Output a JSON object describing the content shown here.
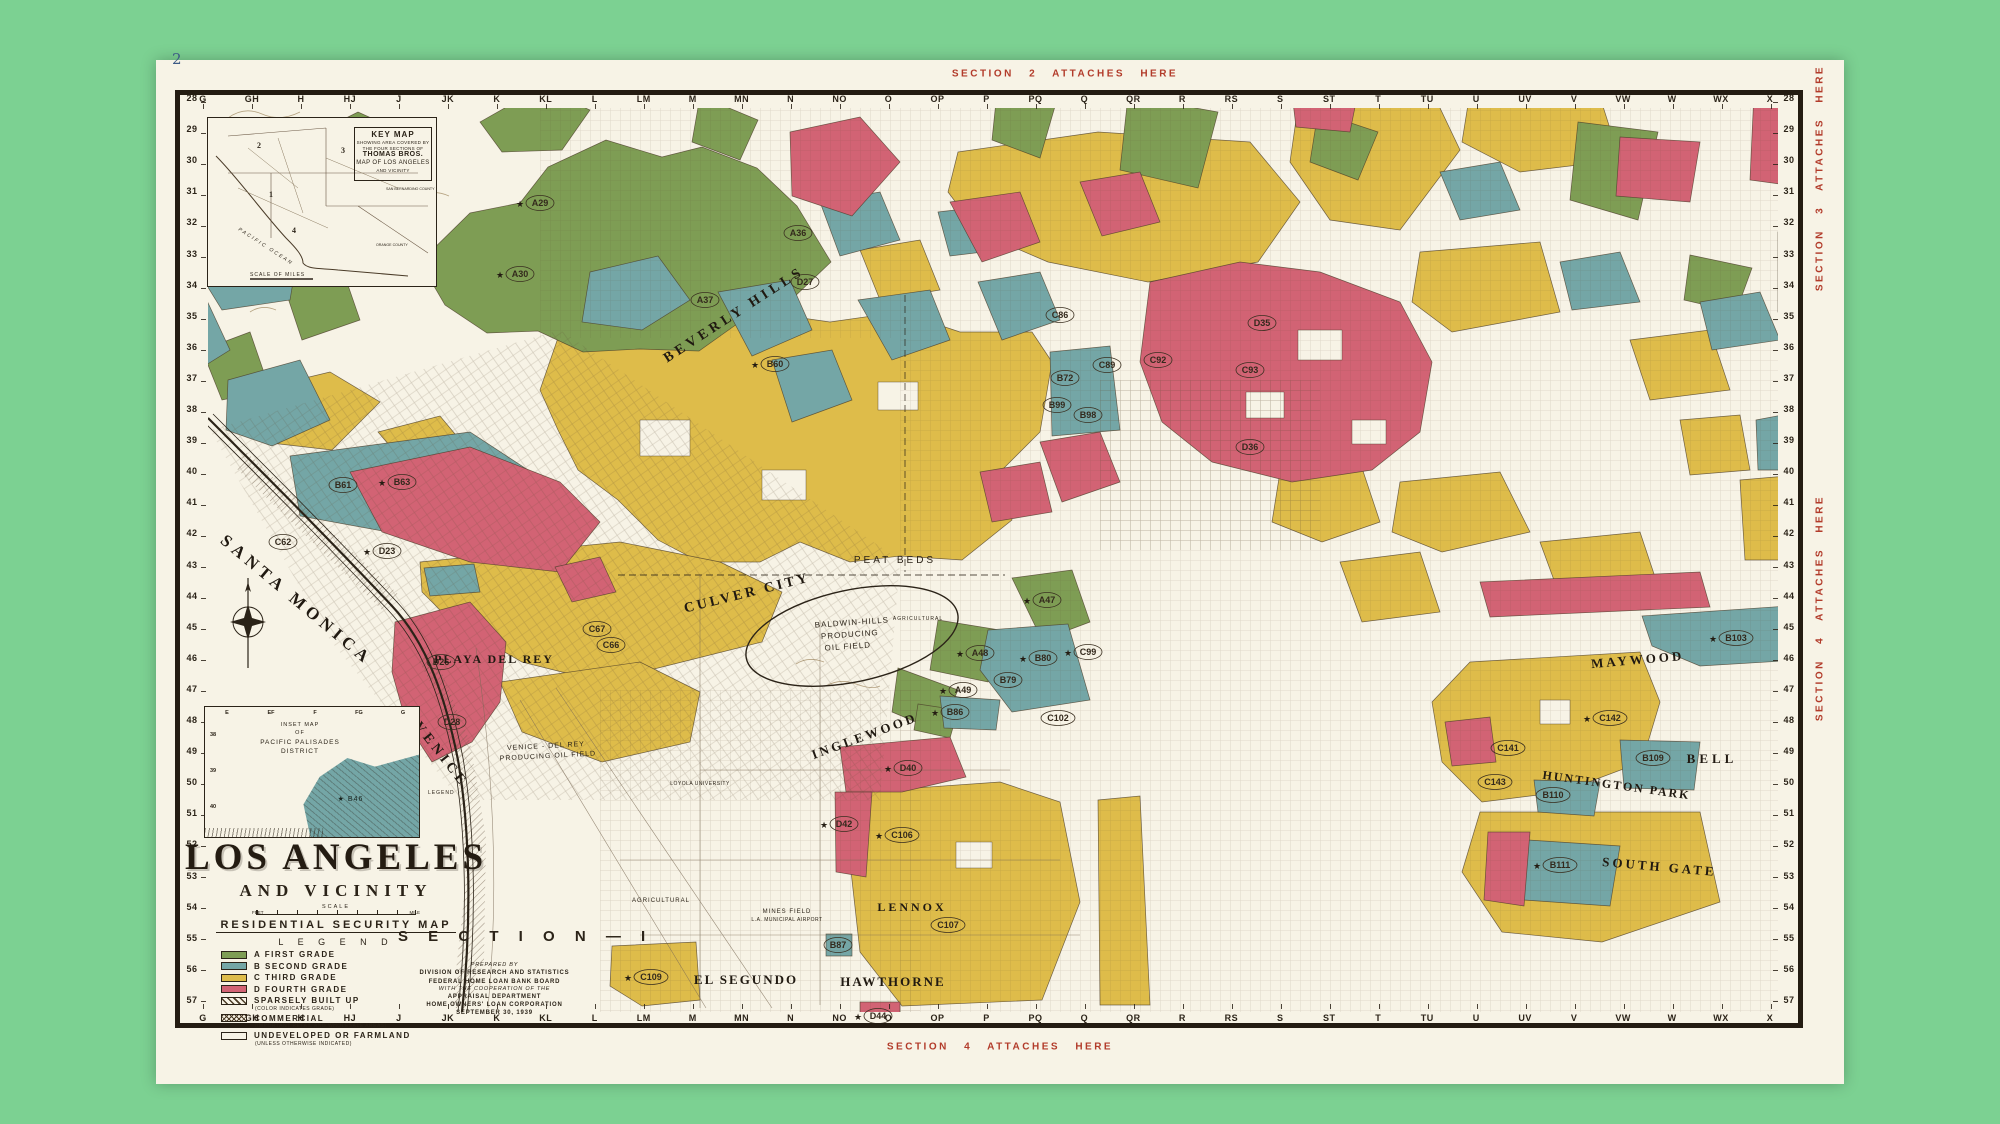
{
  "page": {
    "page_number": "2"
  },
  "colors": {
    "background": "#7cd192",
    "paper": "#f7f3e6",
    "ink": "#2b2318",
    "overprint_red": "#b23b2a",
    "grade_a_green": "#7e9d54",
    "grade_b_blue": "#74a6a6",
    "grade_c_yellow": "#debc4a",
    "grade_d_red": "#d26374"
  },
  "section_stamps": {
    "top": "SECTION 2 ATTACHES HERE",
    "bottom": "SECTION 4 ATTACHES HERE",
    "right_upper": "SECTION 3 ATTACHES HERE",
    "right_lower": "SECTION 4 ATTACHES HERE"
  },
  "title_block": {
    "title": "LOS ANGELES",
    "subtitle": "AND VICINITY",
    "scale_label": "SCALE",
    "scale_feet": "FEET",
    "scale_mile": "MILE",
    "map_type": "RESIDENTIAL SECURITY MAP",
    "legend_heading": "L E G E N D",
    "section_label": "S E C T I O N — I"
  },
  "legend": {
    "items": [
      {
        "swatch": "a",
        "letter": "A",
        "label": "FIRST GRADE",
        "note": ""
      },
      {
        "swatch": "b",
        "letter": "B",
        "label": "SECOND GRADE",
        "note": ""
      },
      {
        "swatch": "c",
        "letter": "C",
        "label": "THIRD GRADE",
        "note": ""
      },
      {
        "swatch": "d",
        "letter": "D",
        "label": "FOURTH GRADE",
        "note": ""
      },
      {
        "swatch": "hatch",
        "letter": "",
        "label": "SPARSELY BUILT UP",
        "note": "(COLOR INDICATES GRADE)"
      },
      {
        "swatch": "commercial",
        "letter": "",
        "label": "COMMERCIAL",
        "note": "(IMPORTANT RETAIL AND WHOLESALE AREAS)"
      },
      {
        "swatch": "white",
        "letter": "",
        "label": "UNDEVELOPED OR FARMLAND",
        "note": "(UNLESS OTHERWISE INDICATED)"
      }
    ]
  },
  "credits": {
    "lines": [
      "PREPARED BY",
      "DIVISION OF RESEARCH AND STATISTICS",
      "FEDERAL HOME LOAN BANK BOARD",
      "WITH THE COOPERATION OF THE",
      "APPRAISAL DEPARTMENT",
      "HOME OWNERS' LOAN CORPORATION",
      "SEPTEMBER 30, 1939"
    ]
  },
  "key_map": {
    "title": "KEY MAP",
    "sub1": "SHOWING AREA COVERED BY",
    "sub2": "THE FOUR SECTIONS OF",
    "publisher": "THOMAS BROS.",
    "sub3": "MAP OF LOS ANGELES",
    "sub4": "AND VICINITY",
    "section_1": "1",
    "section_2": "2",
    "section_3": "3",
    "section_4": "4",
    "ocean_label": "PACIFIC OCEAN",
    "scale_label": "SCALE OF MILES",
    "county_1": "SAN BERNARDINO COUNTY",
    "county_2": "ORANGE COUNTY"
  },
  "inset_map": {
    "line1": "INSET MAP",
    "line2": "OF",
    "line3": "PACIFIC PALISADES",
    "line4": "DISTRICT",
    "zone_label": "B46",
    "col_letters": [
      "E",
      "EF",
      "F",
      "FG",
      "G"
    ],
    "row_numbers": [
      "38",
      "39",
      "40"
    ],
    "legend_label": "LEGEND"
  },
  "frame": {
    "col_letters": [
      "G",
      "GH",
      "H",
      "HJ",
      "J",
      "JK",
      "K",
      "KL",
      "L",
      "LM",
      "M",
      "MN",
      "N",
      "NO",
      "O",
      "OP",
      "P",
      "PQ",
      "Q",
      "QR",
      "R",
      "RS",
      "S",
      "ST",
      "T",
      "TU",
      "U",
      "UV",
      "V",
      "VW",
      "W",
      "WX",
      "X"
    ],
    "row_numbers": [
      "28",
      "29",
      "30",
      "31",
      "32",
      "33",
      "34",
      "35",
      "36",
      "37",
      "38",
      "39",
      "40",
      "41",
      "42",
      "43",
      "44",
      "45",
      "46",
      "47",
      "48",
      "49",
      "50",
      "51",
      "52",
      "53",
      "54",
      "55",
      "56",
      "57"
    ]
  },
  "map_labels": [
    {
      "t": "SANTA MONICA",
      "x": 293,
      "y": 604,
      "r": 40,
      "s": 17,
      "ls": 5,
      "f": "serif"
    },
    {
      "t": "VENICE",
      "x": 438,
      "y": 757,
      "r": 52,
      "s": 14,
      "ls": 4,
      "f": "serif"
    },
    {
      "t": "BEVERLY HILLS",
      "x": 736,
      "y": 318,
      "r": -33,
      "s": 14,
      "ls": 4,
      "f": "serif"
    },
    {
      "t": "CULVER CITY",
      "x": 748,
      "y": 597,
      "r": -14,
      "s": 14,
      "ls": 3,
      "f": "serif"
    },
    {
      "t": "INGLEWOOD",
      "x": 866,
      "y": 740,
      "r": -20,
      "s": 13,
      "ls": 3,
      "f": "serif"
    },
    {
      "t": "PLAYA DEL REY",
      "x": 494,
      "y": 663,
      "r": 0,
      "s": 12,
      "ls": 2,
      "f": "serif"
    },
    {
      "t": "EL SEGUNDO",
      "x": 746,
      "y": 984,
      "r": 0,
      "s": 13,
      "ls": 2,
      "f": "serif"
    },
    {
      "t": "HAWTHORNE",
      "x": 893,
      "y": 986,
      "r": 0,
      "s": 13,
      "ls": 2,
      "f": "serif"
    },
    {
      "t": "LENNOX",
      "x": 912,
      "y": 911,
      "r": 0,
      "s": 12,
      "ls": 3,
      "f": "serif"
    },
    {
      "t": "MAYWOOD",
      "x": 1638,
      "y": 664,
      "r": -5,
      "s": 13,
      "ls": 3,
      "f": "serif"
    },
    {
      "t": "BELL",
      "x": 1712,
      "y": 763,
      "r": 0,
      "s": 13,
      "ls": 4,
      "f": "serif"
    },
    {
      "t": "HUNTINGTON PARK",
      "x": 1616,
      "y": 789,
      "r": 8,
      "s": 12,
      "ls": 2,
      "f": "serif"
    },
    {
      "t": "SOUTH GATE",
      "x": 1659,
      "y": 871,
      "r": 5,
      "s": 13,
      "ls": 3,
      "f": "serif"
    },
    {
      "t": "PEAT BEDS",
      "x": 895,
      "y": 563,
      "r": 0,
      "s": 10,
      "ls": 3,
      "f": "sans"
    },
    {
      "t": "BALDWIN-HILLS",
      "x": 852,
      "y": 625,
      "r": -4,
      "s": 8,
      "ls": 1,
      "f": "sans"
    },
    {
      "t": "PRODUCING",
      "x": 850,
      "y": 637,
      "r": -4,
      "s": 8,
      "ls": 1,
      "f": "sans"
    },
    {
      "t": "OIL FIELD",
      "x": 848,
      "y": 649,
      "r": -4,
      "s": 8,
      "ls": 1,
      "f": "sans"
    },
    {
      "t": "VENICE - DEL REY",
      "x": 546,
      "y": 748,
      "r": -3,
      "s": 7,
      "ls": 1,
      "f": "sans"
    },
    {
      "t": "PRODUCING OIL FIELD",
      "x": 548,
      "y": 758,
      "r": -3,
      "s": 7,
      "ls": 1,
      "f": "sans"
    },
    {
      "t": "MINES FIELD",
      "x": 787,
      "y": 913,
      "r": 0,
      "s": 6,
      "ls": 1,
      "f": "sans"
    },
    {
      "t": "L.A. MUNICIPAL AIRPORT",
      "x": 787,
      "y": 921,
      "r": 0,
      "s": 5,
      "ls": 0.5,
      "f": "sans"
    },
    {
      "t": "LOYOLA UNIVERSITY",
      "x": 700,
      "y": 785,
      "r": 0,
      "s": 5,
      "ls": 0.5,
      "f": "sans"
    },
    {
      "t": "AGRICULTURAL",
      "x": 661,
      "y": 902,
      "r": 0,
      "s": 6,
      "ls": 1,
      "f": "sans"
    },
    {
      "t": "AGRICULTURAL",
      "x": 918,
      "y": 620,
      "r": 0,
      "s": 5,
      "ls": 1,
      "f": "sans"
    }
  ],
  "zone_labels": [
    {
      "c": "A29",
      "x": 540,
      "y": 203,
      "star": true
    },
    {
      "c": "A30",
      "x": 520,
      "y": 274,
      "star": true
    },
    {
      "c": "A36",
      "x": 798,
      "y": 233,
      "star": false
    },
    {
      "c": "A37",
      "x": 705,
      "y": 300,
      "star": false
    },
    {
      "c": "D27",
      "x": 805,
      "y": 282,
      "star": false
    },
    {
      "c": "B60",
      "x": 775,
      "y": 364,
      "star": true
    },
    {
      "c": "B61",
      "x": 343,
      "y": 485,
      "star": false
    },
    {
      "c": "B63",
      "x": 402,
      "y": 482,
      "star": true
    },
    {
      "c": "D23",
      "x": 387,
      "y": 551,
      "star": true
    },
    {
      "c": "C62",
      "x": 283,
      "y": 542,
      "star": false
    },
    {
      "c": "D26",
      "x": 441,
      "y": 662,
      "star": false
    },
    {
      "c": "D28",
      "x": 452,
      "y": 722,
      "star": false
    },
    {
      "c": "C67",
      "x": 597,
      "y": 629,
      "star": false
    },
    {
      "c": "C66",
      "x": 611,
      "y": 645,
      "star": false
    },
    {
      "c": "C86",
      "x": 1060,
      "y": 315,
      "star": false
    },
    {
      "c": "C89",
      "x": 1107,
      "y": 365,
      "star": false
    },
    {
      "c": "B72",
      "x": 1065,
      "y": 378,
      "star": false
    },
    {
      "c": "B99",
      "x": 1057,
      "y": 405,
      "star": false
    },
    {
      "c": "B98",
      "x": 1088,
      "y": 415,
      "star": false
    },
    {
      "c": "C92",
      "x": 1158,
      "y": 360,
      "star": false
    },
    {
      "c": "C93",
      "x": 1250,
      "y": 370,
      "star": false
    },
    {
      "c": "D35",
      "x": 1262,
      "y": 323,
      "star": false
    },
    {
      "c": "D36",
      "x": 1250,
      "y": 447,
      "star": false
    },
    {
      "c": "A47",
      "x": 1047,
      "y": 600,
      "star": true
    },
    {
      "c": "A48",
      "x": 980,
      "y": 653,
      "star": true
    },
    {
      "c": "A49",
      "x": 963,
      "y": 690,
      "star": true
    },
    {
      "c": "B80",
      "x": 1043,
      "y": 658,
      "star": true
    },
    {
      "c": "B79",
      "x": 1008,
      "y": 680,
      "star": false
    },
    {
      "c": "C99",
      "x": 1088,
      "y": 652,
      "star": true
    },
    {
      "c": "C102",
      "x": 1058,
      "y": 718,
      "star": false
    },
    {
      "c": "B86",
      "x": 955,
      "y": 712,
      "star": true
    },
    {
      "c": "D40",
      "x": 908,
      "y": 768,
      "star": true
    },
    {
      "c": "D42",
      "x": 844,
      "y": 824,
      "star": true
    },
    {
      "c": "C106",
      "x": 902,
      "y": 835,
      "star": true
    },
    {
      "c": "C107",
      "x": 948,
      "y": 925,
      "star": false
    },
    {
      "c": "B87",
      "x": 838,
      "y": 945,
      "star": false
    },
    {
      "c": "C109",
      "x": 651,
      "y": 977,
      "star": true
    },
    {
      "c": "D44",
      "x": 878,
      "y": 1016,
      "star": true
    },
    {
      "c": "B103",
      "x": 1736,
      "y": 638,
      "star": true
    },
    {
      "c": "C142",
      "x": 1610,
      "y": 718,
      "star": true
    },
    {
      "c": "C141",
      "x": 1508,
      "y": 748,
      "star": false
    },
    {
      "c": "B109",
      "x": 1653,
      "y": 758,
      "star": false
    },
    {
      "c": "B110",
      "x": 1553,
      "y": 795,
      "star": false
    },
    {
      "c": "B111",
      "x": 1560,
      "y": 865,
      "star": true
    },
    {
      "c": "C143",
      "x": 1495,
      "y": 782,
      "star": false
    }
  ]
}
